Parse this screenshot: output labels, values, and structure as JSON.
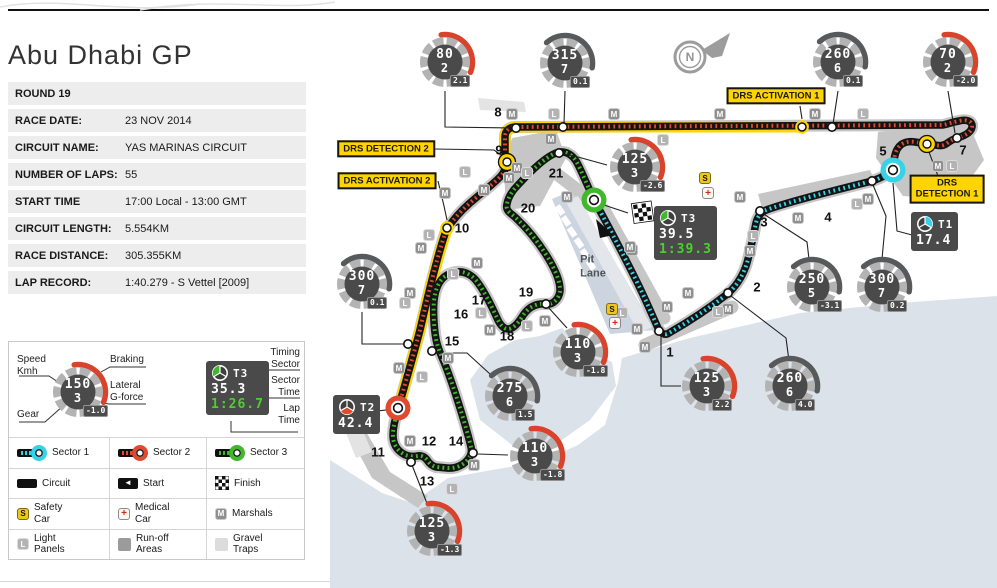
{
  "title": "Abu Dhabi GP",
  "info": {
    "rows": [
      {
        "label": "ROUND 19",
        "value": ""
      },
      {
        "label": "RACE DATE:",
        "value": "23 NOV 2014"
      },
      {
        "label": "CIRCUIT NAME:",
        "value": "YAS MARINAS CIRCUIT"
      },
      {
        "label": "NUMBER OF LAPS:",
        "value": "55"
      },
      {
        "label": "START TIME",
        "value": "17:00 Local - 13:00 GMT"
      },
      {
        "label": "CIRCUIT LENGTH:",
        "value": "5.554KM"
      },
      {
        "label": "RACE DISTANCE:",
        "value": "305.355KM"
      },
      {
        "label": "LAP RECORD:",
        "value": "1:40.279 - S Vettel [2009]"
      }
    ]
  },
  "legend": {
    "sample_gauge": {
      "speed": "150",
      "gear": "3",
      "g": "-1.0",
      "arc": "red"
    },
    "sample_timing": {
      "sector": "T3",
      "color": "green",
      "times": [
        {
          "v": "35.3",
          "c": "w"
        },
        {
          "v": "1:26.7",
          "c": "g"
        }
      ]
    },
    "labels": {
      "speed": "Speed\nKmh",
      "gear": "Gear",
      "braking": "Braking",
      "lateral": "Lateral\nG-force",
      "timing_sector": "Timing\nSector",
      "sector_time": "Sector\nTime",
      "lap_time": "Lap\nTime"
    },
    "items": [
      {
        "icon": "sector1",
        "label": "Sector 1"
      },
      {
        "icon": "sector2",
        "label": "Sector 2"
      },
      {
        "icon": "sector3",
        "label": "Sector 3"
      },
      {
        "icon": "circuit",
        "label": "Circuit"
      },
      {
        "icon": "start",
        "label": "Start"
      },
      {
        "icon": "finish",
        "label": "Finish"
      },
      {
        "icon": "safety",
        "label": "Safety\nCar"
      },
      {
        "icon": "medical",
        "label": "Medical\nCar"
      },
      {
        "icon": "marshals",
        "label": "Marshals"
      },
      {
        "icon": "light",
        "label": "Light\nPanels"
      },
      {
        "icon": "runoff",
        "label": "Run-off\nAreas"
      },
      {
        "icon": "gravel",
        "label": "Gravel\nTraps"
      }
    ]
  },
  "map": {
    "compass": "N",
    "pit_lane": "Pit\nLane",
    "drs": [
      {
        "text": "DRS ACTIVATION 1",
        "x": 776,
        "y": 96
      },
      {
        "text": "DRS\nDETECTION 1",
        "x": 947,
        "y": 189
      },
      {
        "text": "DRS DETECTION 2",
        "x": 386,
        "y": 149
      },
      {
        "text": "DRS ACTIVATION 2",
        "x": 387,
        "y": 181
      }
    ],
    "turns": [
      {
        "n": "1",
        "x": 670,
        "y": 352
      },
      {
        "n": "2",
        "x": 757,
        "y": 287
      },
      {
        "n": "3",
        "x": 764,
        "y": 222
      },
      {
        "n": "4",
        "x": 828,
        "y": 217
      },
      {
        "n": "5",
        "x": 883,
        "y": 151
      },
      {
        "n": "7",
        "x": 963,
        "y": 150
      },
      {
        "n": "8",
        "x": 498,
        "y": 112
      },
      {
        "n": "9",
        "x": 499,
        "y": 150
      },
      {
        "n": "10",
        "x": 462,
        "y": 228
      },
      {
        "n": "11",
        "x": 378,
        "y": 452
      },
      {
        "n": "12",
        "x": 429,
        "y": 441
      },
      {
        "n": "13",
        "x": 427,
        "y": 481
      },
      {
        "n": "14",
        "x": 456,
        "y": 441
      },
      {
        "n": "15",
        "x": 452,
        "y": 341
      },
      {
        "n": "16",
        "x": 461,
        "y": 314
      },
      {
        "n": "17",
        "x": 479,
        "y": 300
      },
      {
        "n": "18",
        "x": 507,
        "y": 336
      },
      {
        "n": "19",
        "x": 526,
        "y": 292
      },
      {
        "n": "20",
        "x": 528,
        "y": 208
      },
      {
        "n": "21",
        "x": 556,
        "y": 173
      }
    ],
    "gauges": [
      {
        "x": 445,
        "y": 62,
        "speed": "80",
        "gear": "2",
        "g": "2.1",
        "arc": "red"
      },
      {
        "x": 565,
        "y": 63,
        "speed": "315",
        "gear": "7",
        "g": "0.1",
        "arc": "dark"
      },
      {
        "x": 838,
        "y": 62,
        "speed": "260",
        "gear": "6",
        "g": "0.1",
        "arc": "dark"
      },
      {
        "x": 948,
        "y": 62,
        "speed": "70",
        "gear": "2",
        "g": "-2.0",
        "arc": "red"
      },
      {
        "x": 635,
        "y": 167,
        "speed": "125",
        "gear": "3",
        "g": "-2.6",
        "arc": "red"
      },
      {
        "x": 362,
        "y": 284,
        "speed": "300",
        "gear": "7",
        "g": "0.1",
        "arc": "dark"
      },
      {
        "x": 812,
        "y": 287,
        "speed": "250",
        "gear": "5",
        "g": "-3.1",
        "arc": "dark"
      },
      {
        "x": 882,
        "y": 287,
        "speed": "300",
        "gear": "7",
        "g": "0.2",
        "arc": "dark"
      },
      {
        "x": 510,
        "y": 396,
        "speed": "275",
        "gear": "6",
        "g": "1.5",
        "arc": "dark"
      },
      {
        "x": 578,
        "y": 352,
        "speed": "110",
        "gear": "3",
        "g": "-1.8",
        "arc": "red"
      },
      {
        "x": 535,
        "y": 456,
        "speed": "110",
        "gear": "3",
        "g": "-1.8",
        "arc": "red"
      },
      {
        "x": 432,
        "y": 531,
        "speed": "125",
        "gear": "3",
        "g": "-1.3",
        "arc": "red"
      },
      {
        "x": 707,
        "y": 386,
        "speed": "125",
        "gear": "3",
        "g": "2.2",
        "arc": "red"
      },
      {
        "x": 790,
        "y": 386,
        "speed": "260",
        "gear": "6",
        "g": "4.0",
        "arc": "dark"
      }
    ],
    "timing_boxes": [
      {
        "x": 911,
        "y": 212,
        "sector": "T1",
        "color": "cyan",
        "times": [
          {
            "v": "17.4",
            "c": "w"
          }
        ]
      },
      {
        "x": 333,
        "y": 395,
        "sector": "T2",
        "color": "orange",
        "times": [
          {
            "v": "42.4",
            "c": "w"
          }
        ]
      },
      {
        "x": 654,
        "y": 206,
        "sector": "T3",
        "color": "green",
        "times": [
          {
            "v": "39.5",
            "c": "w"
          },
          {
            "v": "1:39.3",
            "c": "g"
          }
        ]
      }
    ],
    "badges": [
      [
        "M",
        512,
        114
      ],
      [
        "M",
        614,
        114
      ],
      [
        "M",
        720,
        114
      ],
      [
        "M",
        815,
        114
      ],
      [
        "M",
        551,
        139
      ],
      [
        "M",
        938,
        166
      ],
      [
        "M",
        868,
        199
      ],
      [
        "M",
        740,
        197
      ],
      [
        "M",
        798,
        218
      ],
      [
        "M",
        750,
        251
      ],
      [
        "M",
        632,
        250
      ],
      [
        "M",
        688,
        293
      ],
      [
        "M",
        667,
        307
      ],
      [
        "M",
        728,
        309
      ],
      [
        "M",
        637,
        329
      ],
      [
        "M",
        645,
        347
      ],
      [
        "M",
        567,
        197
      ],
      [
        "M",
        630,
        247
      ],
      [
        "M",
        517,
        168
      ],
      [
        "M",
        509,
        178
      ],
      [
        "M",
        484,
        190
      ],
      [
        "M",
        445,
        193
      ],
      [
        "M",
        421,
        248
      ],
      [
        "M",
        410,
        293
      ],
      [
        "M",
        399,
        368
      ],
      [
        "M",
        448,
        358
      ],
      [
        "M",
        477,
        263
      ],
      [
        "M",
        490,
        330
      ],
      [
        "M",
        545,
        321
      ],
      [
        "M",
        410,
        441
      ],
      [
        "M",
        474,
        465
      ],
      [
        "L",
        554,
        114
      ],
      [
        "L",
        863,
        114
      ],
      [
        "L",
        663,
        140
      ],
      [
        "L",
        952,
        166
      ],
      [
        "L",
        857,
        204
      ],
      [
        "L",
        753,
        236
      ],
      [
        "L",
        465,
        172
      ],
      [
        "L",
        527,
        173
      ],
      [
        "L",
        429,
        235
      ],
      [
        "L",
        405,
        303
      ],
      [
        "L",
        422,
        377
      ],
      [
        "L",
        453,
        274
      ],
      [
        "L",
        481,
        313
      ],
      [
        "L",
        527,
        326
      ],
      [
        "L",
        718,
        312
      ],
      [
        "L",
        622,
        313
      ],
      [
        "L",
        452,
        489
      ],
      [
        "S",
        612,
        309
      ],
      [
        "S",
        705,
        178
      ],
      [
        "+",
        615,
        323
      ],
      [
        "+",
        708,
        193
      ]
    ]
  },
  "colors": {
    "sector1": "#35d2e8",
    "sector2": "#e04a2e",
    "sector3": "#3fb82c",
    "drs_yellow": "#ffd400",
    "gauge_dark": "#4a4a4a",
    "ring_gray": "#b3b3b3",
    "brake_red": "#d8432c",
    "dark_arc": "#58595b",
    "lap_green": "#4ad22c",
    "sea": "#dbe2ea",
    "runoff": "#c6c6c6",
    "gravel": "#e3e3e3"
  }
}
